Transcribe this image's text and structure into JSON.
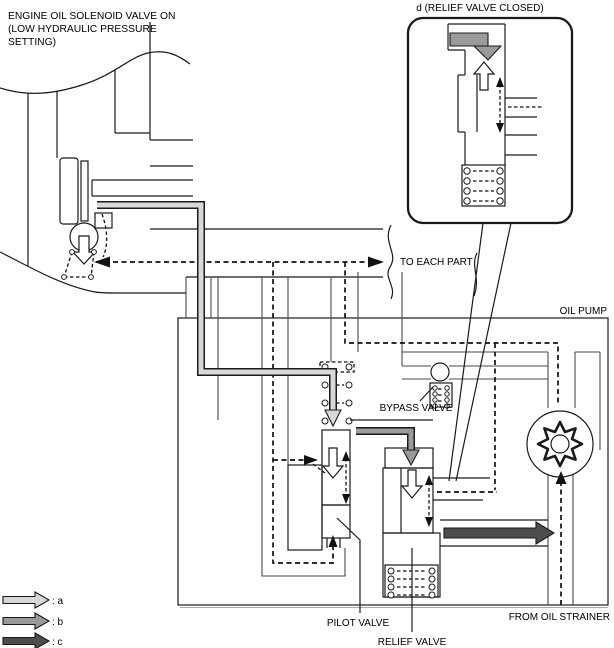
{
  "title": {
    "line1": "ENGINE OIL SOLENOID VALVE ON",
    "line2": "(LOW HYDRAULIC PRESSURE",
    "line3": "SETTING)"
  },
  "callout": {
    "title": "d (RELIEF VALVE CLOSED)"
  },
  "labels": {
    "to_each_part": "TO EACH PART",
    "oil_pump": "OIL PUMP",
    "bypass_valve": "BYPASS VALVE",
    "pilot_valve": "PILOT VALVE",
    "relief_valve": "RELIEF VALVE",
    "from_oil_strainer": "FROM OIL STRAINER"
  },
  "legend": {
    "items": [
      {
        "label": ": a",
        "color": "#d8d8d8"
      },
      {
        "label": ": b",
        "color": "#9a9a9a"
      },
      {
        "label": ": c",
        "color": "#4d4d4d"
      }
    ]
  },
  "colors": {
    "flow_a": "#d8d8d8",
    "flow_b": "#9a9a9a",
    "flow_c": "#4d4d4d",
    "line": "#1a1a1a",
    "background": "#ffffff"
  }
}
